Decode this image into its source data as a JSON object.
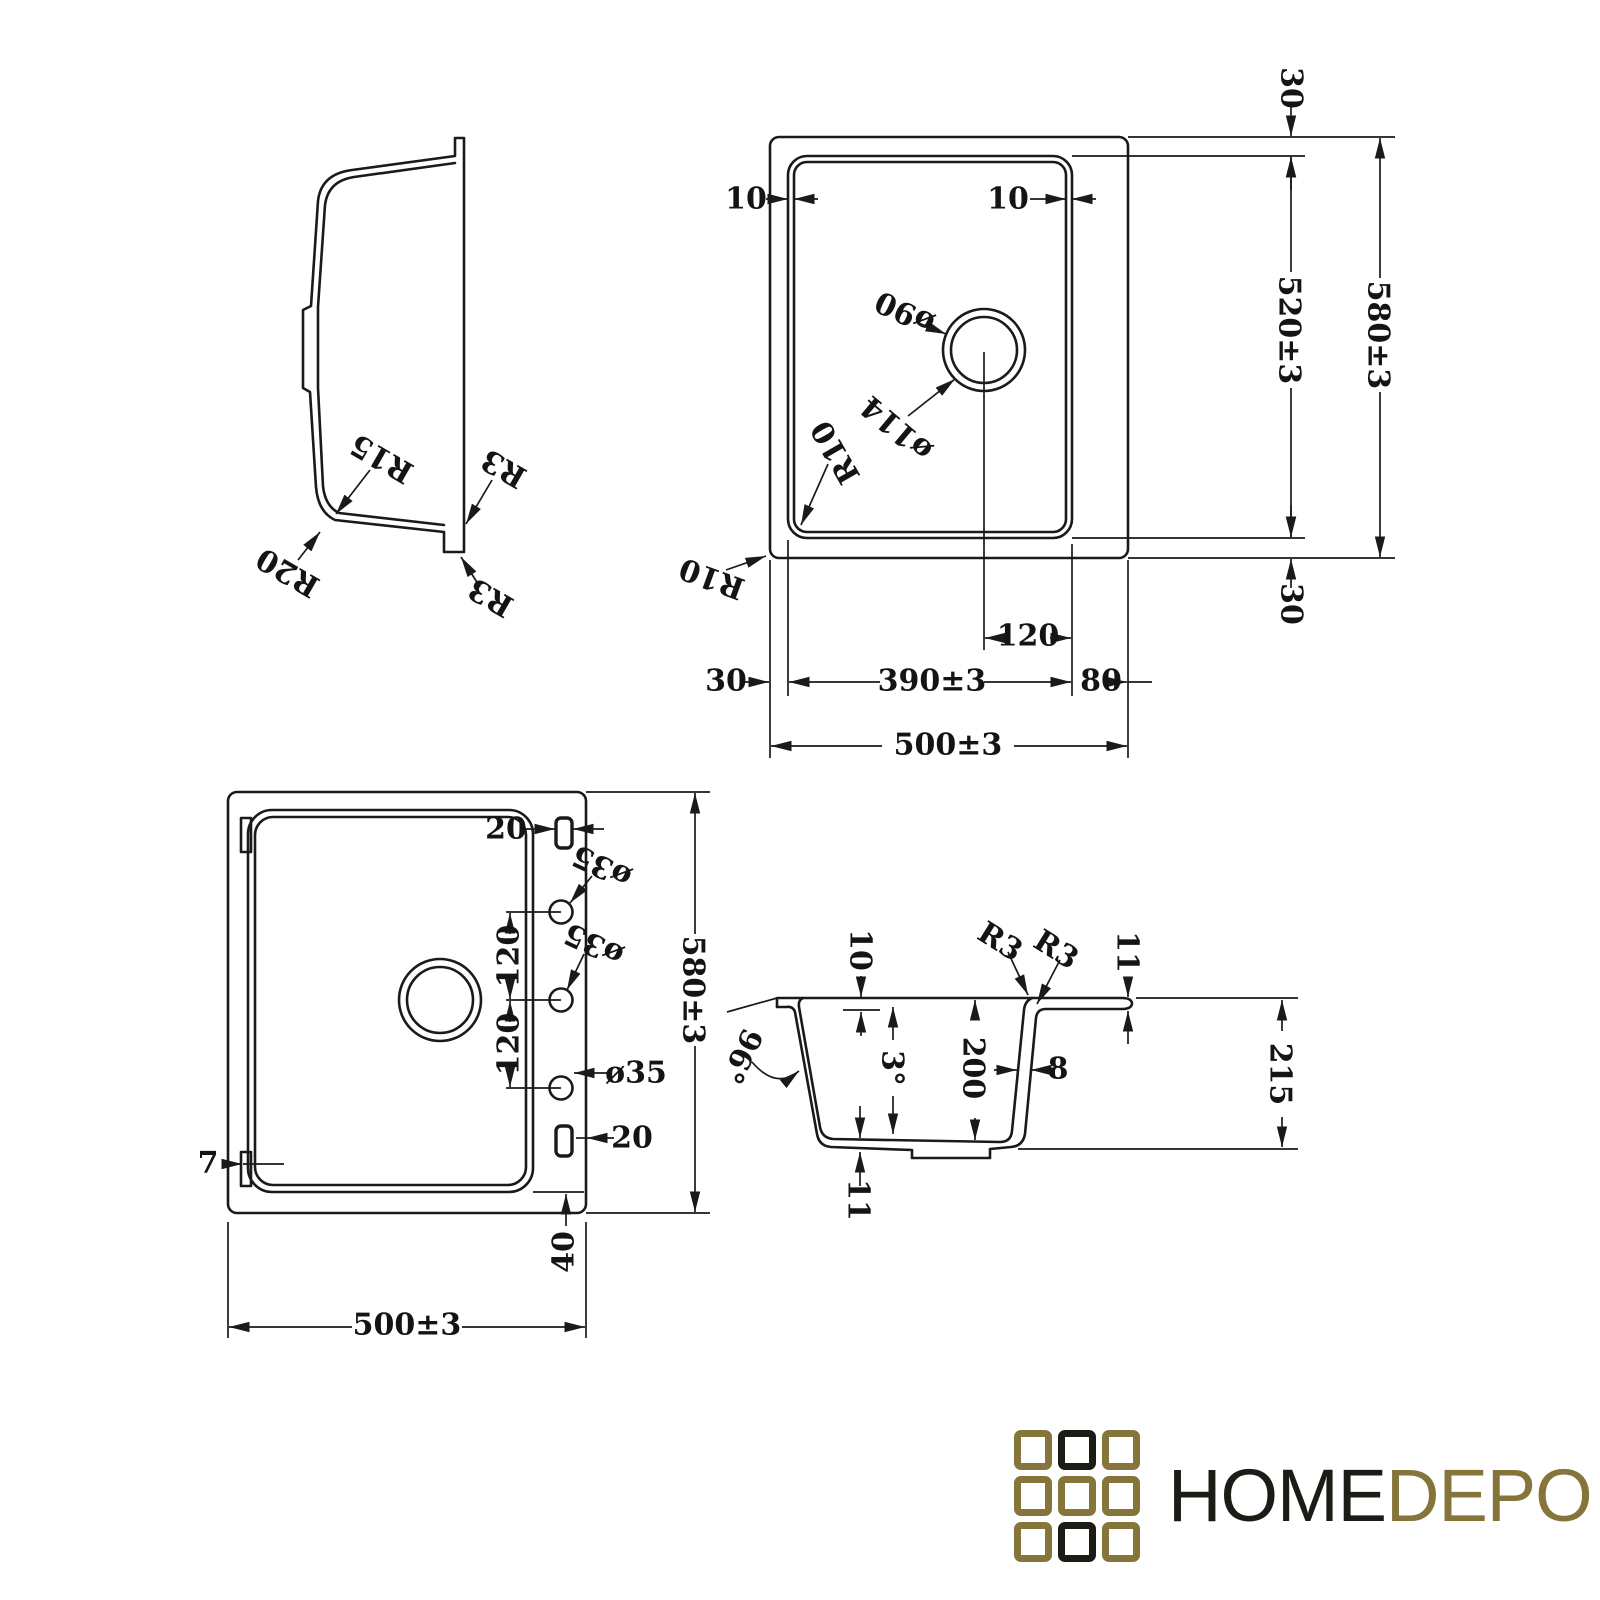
{
  "drawing": {
    "ink_color": "#1a1a1a",
    "views": {
      "side_profile": {
        "labels": {
          "r15": "R15",
          "r20": "R20",
          "r3_upper": "R3",
          "r3_lower": "R3"
        }
      },
      "top": {
        "labels": {
          "rim_lip_left": "10",
          "rim_lip_right": "10",
          "edge_top": "30",
          "bowl_length": "520±3",
          "overall_length": "580±3",
          "edge_bottom": "30",
          "drain_dia": "ø90",
          "drain_flange_dia": "ø114",
          "corner_radius_inner": "R10",
          "corner_radius_outer": "R10",
          "drain_offset": "120",
          "edge_left": "30",
          "bowl_width": "390±3",
          "deck_width": "80",
          "overall_width": "500±3"
        }
      },
      "bottom": {
        "labels": {
          "clip_slot_top": "20",
          "tap_hole_1": "ø35",
          "tap_hole_2": "ø35",
          "tap_hole_3": "ø35",
          "hole_pitch_1": "120",
          "hole_pitch_2": "120",
          "overall_length": "580±3",
          "tab_width": "7",
          "clip_slot_bottom": "20",
          "edge_strip": "40",
          "overall_width": "500±3"
        }
      },
      "section": {
        "labels": {
          "rim_drop": "10",
          "radius_rim_1": "R3",
          "radius_rim_2": "R3",
          "rim_thickness": "11",
          "outer_wall_angle": "96°",
          "wall_draft_angle": "3°",
          "bowl_depth": "200",
          "wall_thickness": "8",
          "overall_depth": "215",
          "base_thickness": "11"
        }
      }
    }
  },
  "logo": {
    "word_home": "HOME",
    "word_depo": "DEPO",
    "colors": {
      "gold": "#86753A",
      "black": "#1d1b16"
    },
    "grid": [
      "gold",
      "black",
      "gold",
      "gold",
      "gold",
      "gold",
      "gold",
      "black",
      "gold"
    ]
  }
}
